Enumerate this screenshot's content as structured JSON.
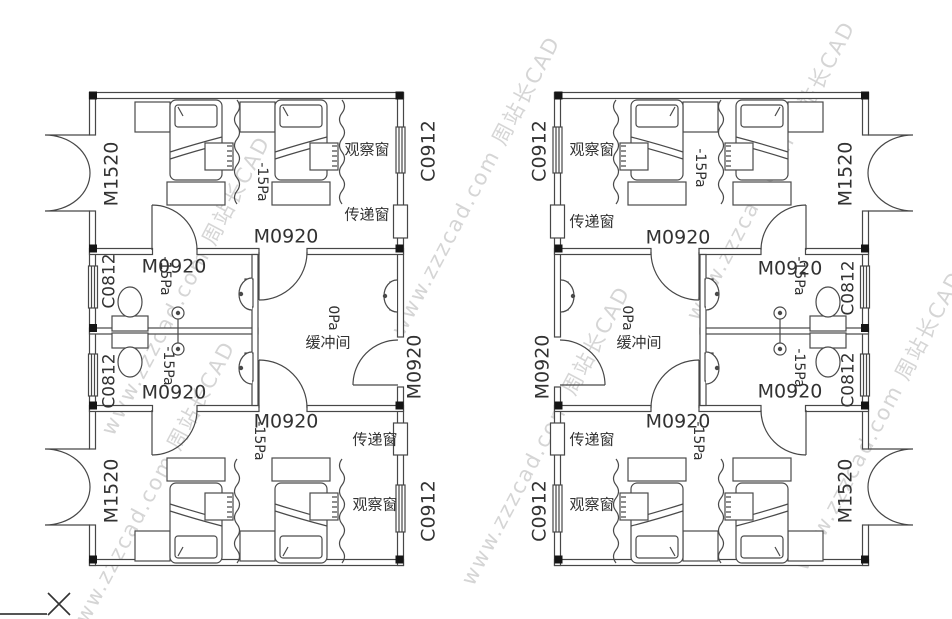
{
  "drawing": {
    "type": "negative-pressure-isolation-ward-floor-plan",
    "watermark": {
      "brand": "周站长CAD",
      "url": "www.zzzcad.com",
      "color": "#cbcbcb"
    },
    "terms": {
      "buffer_room": "缓冲间",
      "observation_window": "观察窗",
      "transfer_window": "传递窗",
      "ward_pressure": "-15Pa",
      "buffer_pressure": "0Pa",
      "double_exterior_door": "M1520",
      "single_door": "M0920",
      "corridor_window": "C0912",
      "bathroom_window": "C0812"
    },
    "labels": [
      {
        "name": "door-label-m1520-left-top",
        "text": "M1520",
        "x": 112,
        "y": 174,
        "rot": -90,
        "fs": 19
      },
      {
        "name": "door-label-m1520-left-bottom",
        "text": "M1520",
        "x": 112,
        "y": 491,
        "rot": -90,
        "fs": 19
      },
      {
        "name": "window-label-c0812-left-top",
        "text": "C0812",
        "x": 110,
        "y": 281,
        "rot": -90,
        "fs": 17
      },
      {
        "name": "window-label-c0812-left-bottom",
        "text": "C0812",
        "x": 110,
        "y": 381,
        "rot": -90,
        "fs": 17
      },
      {
        "name": "window-label-c0912-left-top",
        "text": "C0912",
        "x": 429,
        "y": 151,
        "rot": -90,
        "fs": 19
      },
      {
        "name": "window-label-c0912-left-bottom",
        "text": "C0912",
        "x": 429,
        "y": 511,
        "rot": -90,
        "fs": 19
      },
      {
        "name": "door-label-m0920-left-buffer-exit",
        "text": "M0920",
        "x": 415,
        "y": 367,
        "rot": -90,
        "fs": 19
      },
      {
        "name": "pressure-left-ward-top",
        "text": "-15Pa",
        "x": 262,
        "y": 182,
        "rot": 90,
        "fs": 14
      },
      {
        "name": "pressure-left-ward-bottom",
        "text": "-15Pa",
        "x": 259,
        "y": 441,
        "rot": 90,
        "fs": 14
      },
      {
        "name": "pressure-left-bath-top",
        "text": "-15Pa",
        "x": 165,
        "y": 276,
        "rot": 90,
        "fs": 14
      },
      {
        "name": "pressure-left-bath-bottom",
        "text": "-15Pa",
        "x": 168,
        "y": 366,
        "rot": 90,
        "fs": 14
      },
      {
        "name": "pressure-left-buffer",
        "text": "0Pa",
        "x": 333,
        "y": 318,
        "rot": 90,
        "fs": 14
      },
      {
        "name": "room-label-buffer-left",
        "text": "缓冲间",
        "x": 328,
        "y": 343,
        "rot": 0,
        "fs": 15
      },
      {
        "name": "door-label-m0920-left-buffer-top",
        "text": "M0920",
        "x": 286,
        "y": 237,
        "rot": 0,
        "fs": 19
      },
      {
        "name": "door-label-m0920-left-bath-top",
        "text": "M0920",
        "x": 174,
        "y": 267,
        "rot": 0,
        "fs": 19
      },
      {
        "name": "door-label-m0920-left-bath-bottom",
        "text": "M0920",
        "x": 174,
        "y": 393,
        "rot": 0,
        "fs": 19
      },
      {
        "name": "door-label-m0920-left-buffer-bottom",
        "text": "M0920",
        "x": 286,
        "y": 422,
        "rot": 0,
        "fs": 19
      },
      {
        "name": "obs-window-left-top",
        "text": "观察窗",
        "x": 367,
        "y": 150,
        "rot": 0,
        "fs": 15
      },
      {
        "name": "pass-window-left-top",
        "text": "传递窗",
        "x": 367,
        "y": 215,
        "rot": 0,
        "fs": 15
      },
      {
        "name": "pass-window-left-bottom",
        "text": "传递窗",
        "x": 375,
        "y": 440,
        "rot": 0,
        "fs": 15
      },
      {
        "name": "obs-window-left-bottom",
        "text": "观察窗",
        "x": 375,
        "y": 505,
        "rot": 0,
        "fs": 15
      },
      {
        "name": "door-label-m1520-right-top",
        "text": "M1520",
        "x": 846,
        "y": 174,
        "rot": -90,
        "fs": 19
      },
      {
        "name": "door-label-m1520-right-bottom",
        "text": "M1520",
        "x": 846,
        "y": 491,
        "rot": -90,
        "fs": 19
      },
      {
        "name": "window-label-c0812-right-top",
        "text": "C0812",
        "x": 849,
        "y": 288,
        "rot": -90,
        "fs": 17
      },
      {
        "name": "window-label-c0812-right-bottom",
        "text": "C0812",
        "x": 849,
        "y": 380,
        "rot": -90,
        "fs": 17
      },
      {
        "name": "window-label-c0912-right-top",
        "text": "C0912",
        "x": 540,
        "y": 151,
        "rot": -90,
        "fs": 19
      },
      {
        "name": "window-label-c0912-right-bottom",
        "text": "C0912",
        "x": 540,
        "y": 511,
        "rot": -90,
        "fs": 19
      },
      {
        "name": "door-label-m0920-right-buffer-exit",
        "text": "M0920",
        "x": 543,
        "y": 367,
        "rot": -90,
        "fs": 19
      },
      {
        "name": "pressure-right-ward-top",
        "text": "-15Pa",
        "x": 700,
        "y": 168,
        "rot": 90,
        "fs": 14
      },
      {
        "name": "pressure-right-ward-bottom",
        "text": "-15Pa",
        "x": 698,
        "y": 441,
        "rot": 90,
        "fs": 14
      },
      {
        "name": "pressure-right-bath-top",
        "text": "-15Pa",
        "x": 799,
        "y": 276,
        "rot": 90,
        "fs": 14
      },
      {
        "name": "pressure-right-bath-bottom",
        "text": "-15Pa",
        "x": 799,
        "y": 368,
        "rot": 90,
        "fs": 14
      },
      {
        "name": "pressure-right-buffer",
        "text": "0Pa",
        "x": 627,
        "y": 318,
        "rot": 90,
        "fs": 14
      },
      {
        "name": "room-label-buffer-right",
        "text": "缓冲间",
        "x": 639,
        "y": 343,
        "rot": 0,
        "fs": 15
      },
      {
        "name": "door-label-m0920-right-buffer-top",
        "text": "M0920",
        "x": 678,
        "y": 238,
        "rot": 0,
        "fs": 19
      },
      {
        "name": "door-label-m0920-right-bath-top",
        "text": "M0920",
        "x": 790,
        "y": 269,
        "rot": 0,
        "fs": 19
      },
      {
        "name": "door-label-m0920-right-bath-bottom",
        "text": "M0920",
        "x": 790,
        "y": 392,
        "rot": 0,
        "fs": 19
      },
      {
        "name": "door-label-m0920-right-buffer-bottom",
        "text": "M0920",
        "x": 678,
        "y": 422,
        "rot": 0,
        "fs": 19
      },
      {
        "name": "obs-window-right-top",
        "text": "观察窗",
        "x": 592,
        "y": 150,
        "rot": 0,
        "fs": 15
      },
      {
        "name": "pass-window-right-top",
        "text": "传递窗",
        "x": 592,
        "y": 222,
        "rot": 0,
        "fs": 15
      },
      {
        "name": "pass-window-right-bottom",
        "text": "传递窗",
        "x": 592,
        "y": 440,
        "rot": 0,
        "fs": 15
      },
      {
        "name": "obs-window-right-bottom",
        "text": "观察窗",
        "x": 592,
        "y": 505,
        "rot": 0,
        "fs": 15
      }
    ],
    "watermark_positions": [
      {
        "x": 185,
        "y": 285
      },
      {
        "x": 475,
        "y": 185
      },
      {
        "x": 770,
        "y": 170
      },
      {
        "x": 545,
        "y": 435
      },
      {
        "x": 878,
        "y": 420
      },
      {
        "x": 150,
        "y": 490
      }
    ]
  }
}
